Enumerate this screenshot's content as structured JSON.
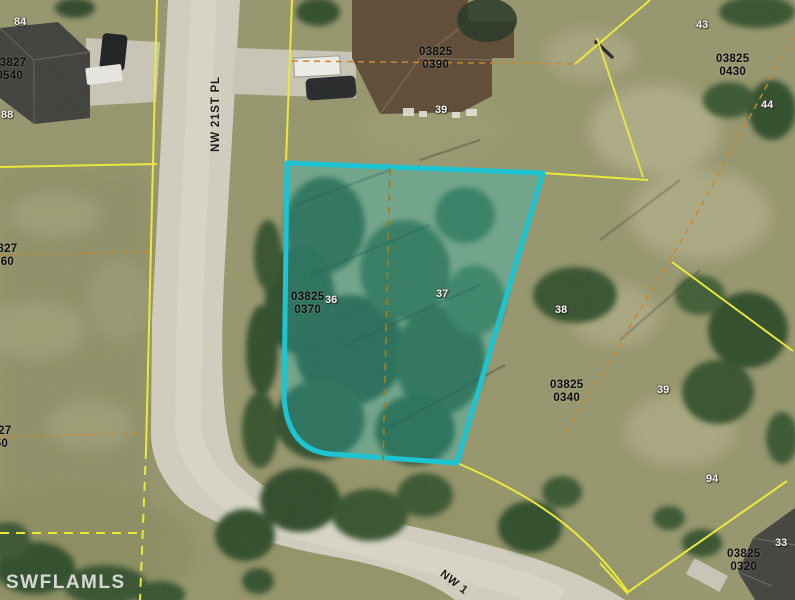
{
  "map": {
    "watermark": "SWFLAMLS",
    "street_labels": [
      {
        "text": "NW 21ST PL"
      },
      {
        "text": "NW 1"
      }
    ],
    "subject_parcel": {
      "highlight_color": "#1cc5d1",
      "block_lot": "03825 0370",
      "lot_numbers": [
        "36",
        "37"
      ]
    },
    "parcel_id_labels": [
      {
        "line1": "03827",
        "line2": "0540"
      },
      {
        "line1": "03825",
        "line2": "0390"
      },
      {
        "line1": "03825",
        "line2": "0430"
      },
      {
        "line1": "03827",
        "line2": "0560"
      },
      {
        "line1": "03825",
        "line2": "0370"
      },
      {
        "line1": "03825",
        "line2": "0340"
      },
      {
        "line1": "03827",
        "line2": "0550"
      },
      {
        "line1": "03825",
        "line2": "0320"
      }
    ],
    "lot_number_labels": [
      {
        "text": "84"
      },
      {
        "text": "88"
      },
      {
        "text": "39"
      },
      {
        "text": "43"
      },
      {
        "text": "44"
      },
      {
        "text": "36"
      },
      {
        "text": "37"
      },
      {
        "text": "38"
      },
      {
        "text": "39"
      },
      {
        "text": "94"
      },
      {
        "text": "33"
      }
    ],
    "colors": {
      "parcel_highlight": "#1cc5d1",
      "boundary_yellow": "#ebe93c",
      "boundary_orange": "#c8882f"
    }
  }
}
